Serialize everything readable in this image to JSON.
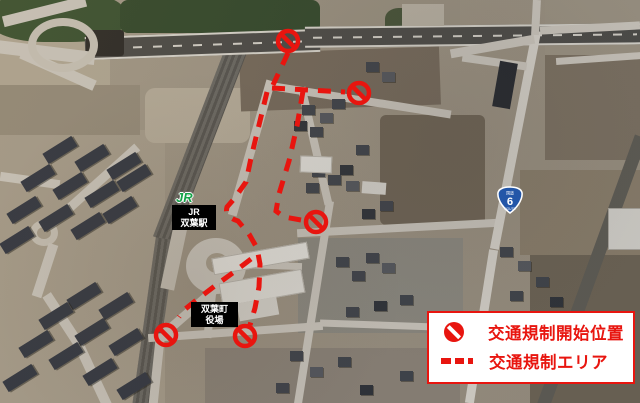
{
  "colors": {
    "annotation_red": "#e8150f",
    "jr_green": "#15a348",
    "route_shield_blue": "#2356a8",
    "label_bg": "#000000",
    "label_text": "#ffffff",
    "legend_bg": "#ffffff"
  },
  "map_labels": {
    "jr_logo": "JR",
    "station": {
      "line1": "JR",
      "line2": "双葉駅"
    },
    "town_hall": {
      "line1": "双葉町",
      "line2": "役場"
    },
    "route_shield": {
      "top": "国道",
      "number": "6",
      "bottom": "ROUTE"
    }
  },
  "legend": {
    "items": [
      {
        "icon": "no-entry-icon",
        "label": "交通規制開始位置"
      },
      {
        "icon": "dashed-line-icon",
        "label": "交通規制エリア"
      }
    ]
  },
  "overlay": {
    "dash_paths": [
      "M288 53 L273 85",
      "M272 88 L345 92",
      "M303 91 L297 126 L289 161 L279 194 L276 211 L284 217 L301 220",
      "M267 92 L259 125 L251 158 L246 182 L234 199 L227 207 C225 214 229 218 238 221 L249 234 L257 248 L260 264 L259 287 L255 308 L250 325",
      "M251 259 L234 272 L216 285 L199 298 L184 310 L179 317"
    ],
    "no_entry_points": [
      [
        288,
        41
      ],
      [
        359,
        93
      ],
      [
        316,
        222
      ],
      [
        245,
        336
      ],
      [
        166,
        335
      ]
    ],
    "style": {
      "stroke_width": 5,
      "dash_array": "13 10",
      "ring_radius": 10,
      "ring_stroke": 4.5
    }
  }
}
